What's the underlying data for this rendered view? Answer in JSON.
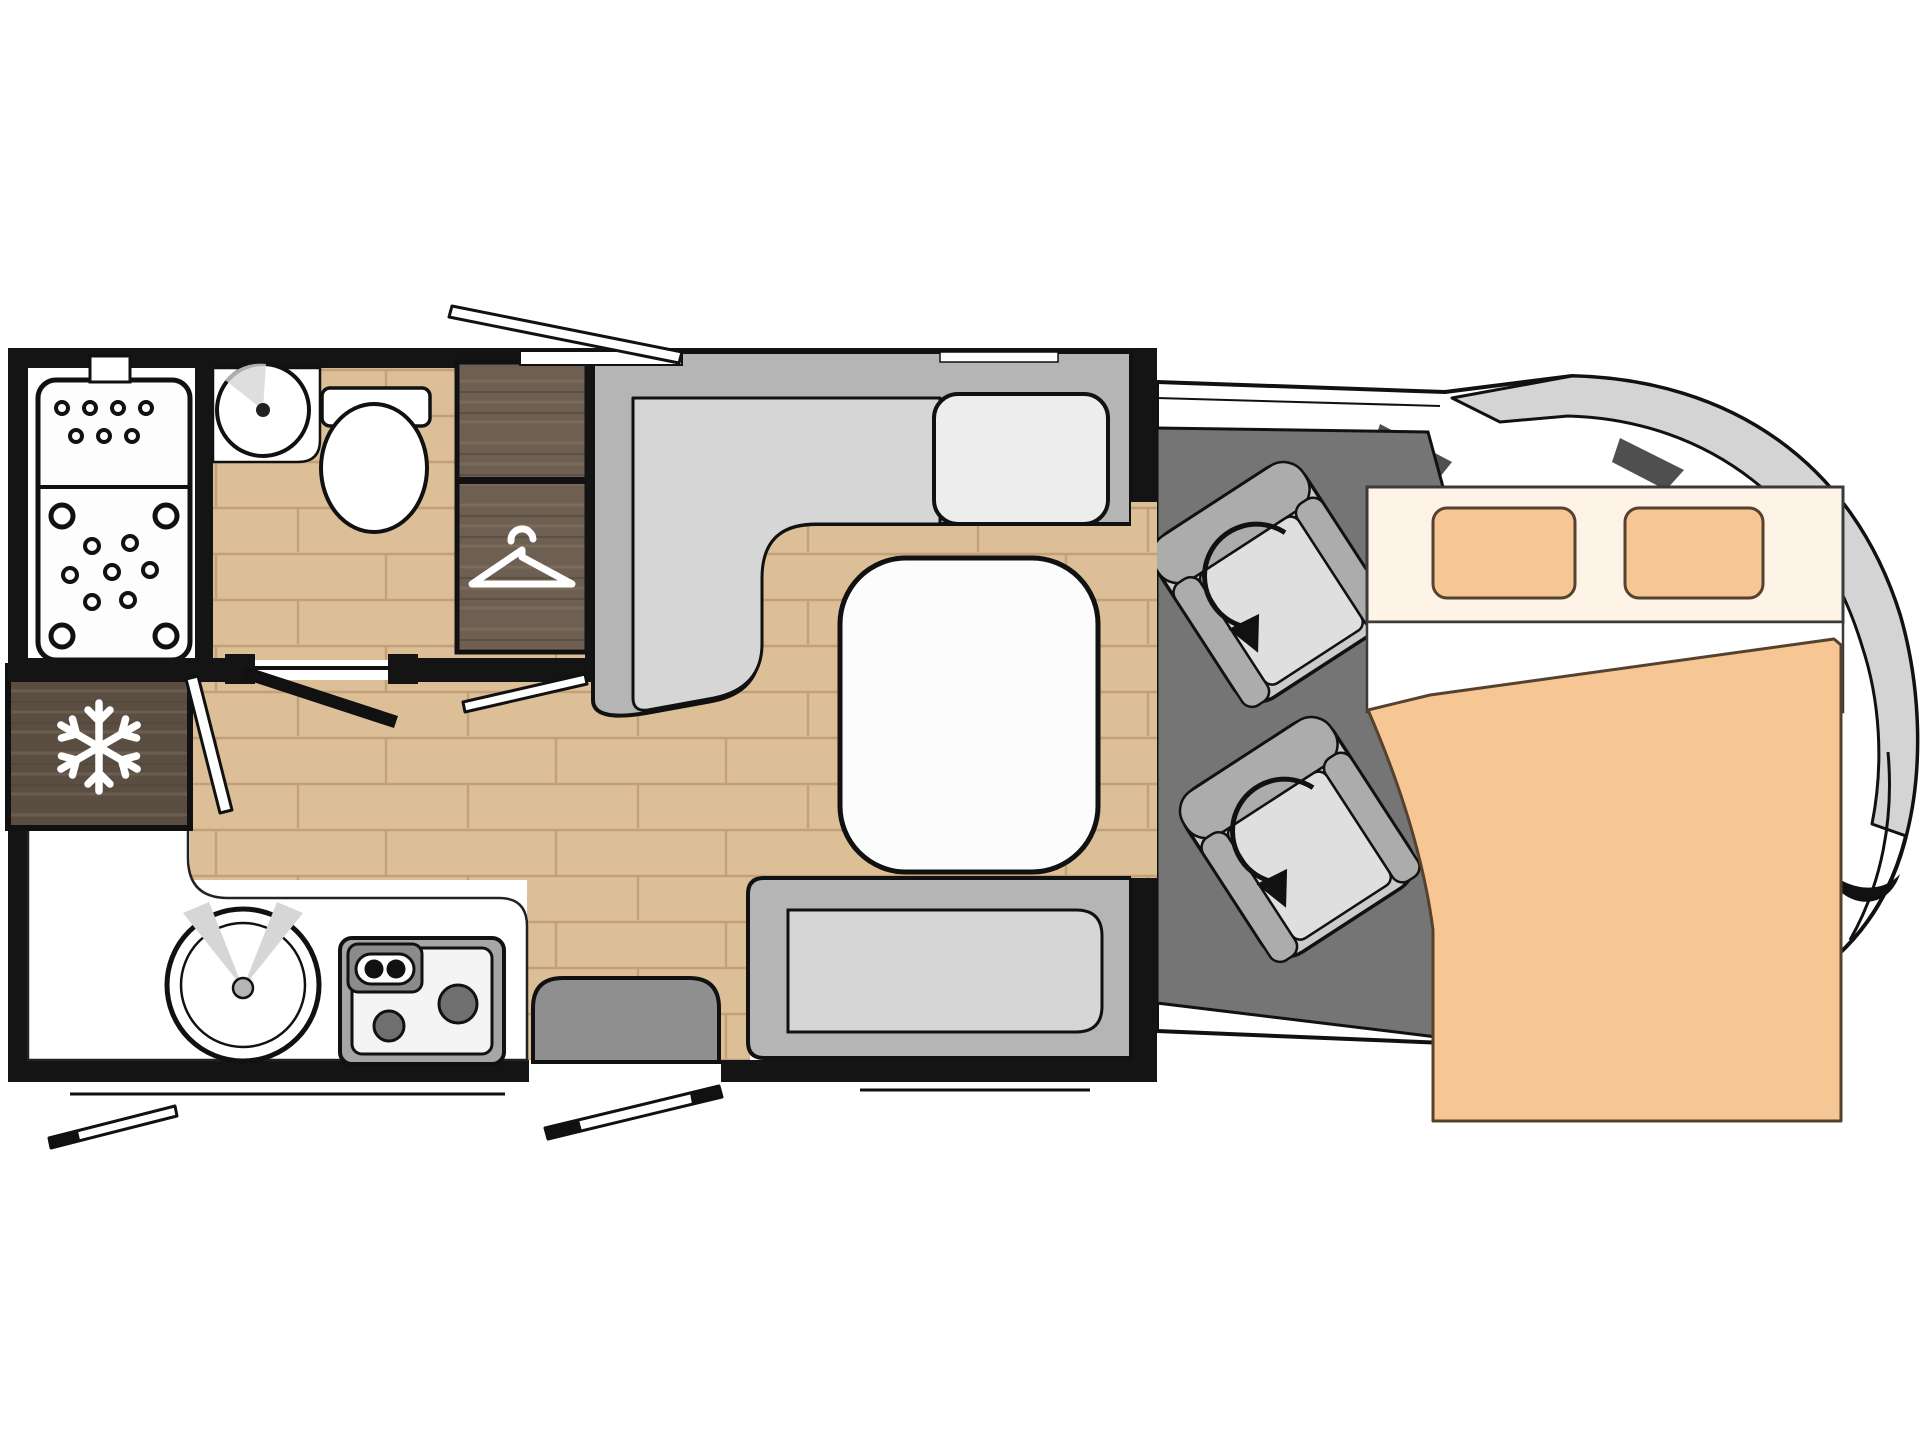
{
  "diagram": {
    "kind": "motorhome-floorplan-top-view",
    "visible_text": [],
    "icons": [
      {
        "name": "snowflake-icon",
        "meaning": "refrigerator"
      },
      {
        "name": "hanger-icon",
        "meaning": "wardrobe"
      },
      {
        "name": "rotation-arrow-icon",
        "meaning": "swivel cab seat"
      },
      {
        "name": "shower-holes-icon",
        "meaning": "shower tray"
      }
    ],
    "rooms": [
      "shower",
      "bathroom",
      "wardrobe",
      "refrigerator",
      "kitchen",
      "dinette",
      "cab",
      "bed-over-cab"
    ]
  },
  "colors": {
    "wall": "#141414",
    "paper": "#ffffff",
    "wood": "#dcbe97",
    "woodline": "#c2a179",
    "darkwood": "#6d5f51",
    "darkwoodHi": "#83735f",
    "fridgewood": "#5a4d41",
    "sofaBase": "#b5b5b5",
    "sofaSeat": "#d6d6d6",
    "cushion": "#ededed",
    "tableFill": "#fcfcfc",
    "cabFloor": "#757575",
    "seatBase": "#cbcbcb",
    "seatBolster": "#acacac",
    "seatPad": "#dfdfdf",
    "bedCream": "#fdf3e6",
    "pillow": "#f6c695",
    "pillowEdge": "#55422e",
    "blanket": "#f6c695",
    "vanGray": "#d4d4d4",
    "stepGray": "#8f8f8f",
    "stoveGray": "#a6a6a6",
    "stovePanel": "#8b8b8b",
    "burner": "#6f6f6f",
    "cooktop": "#f4f4f4",
    "sinkShade": "#d6d6d6",
    "line": "#111111"
  }
}
